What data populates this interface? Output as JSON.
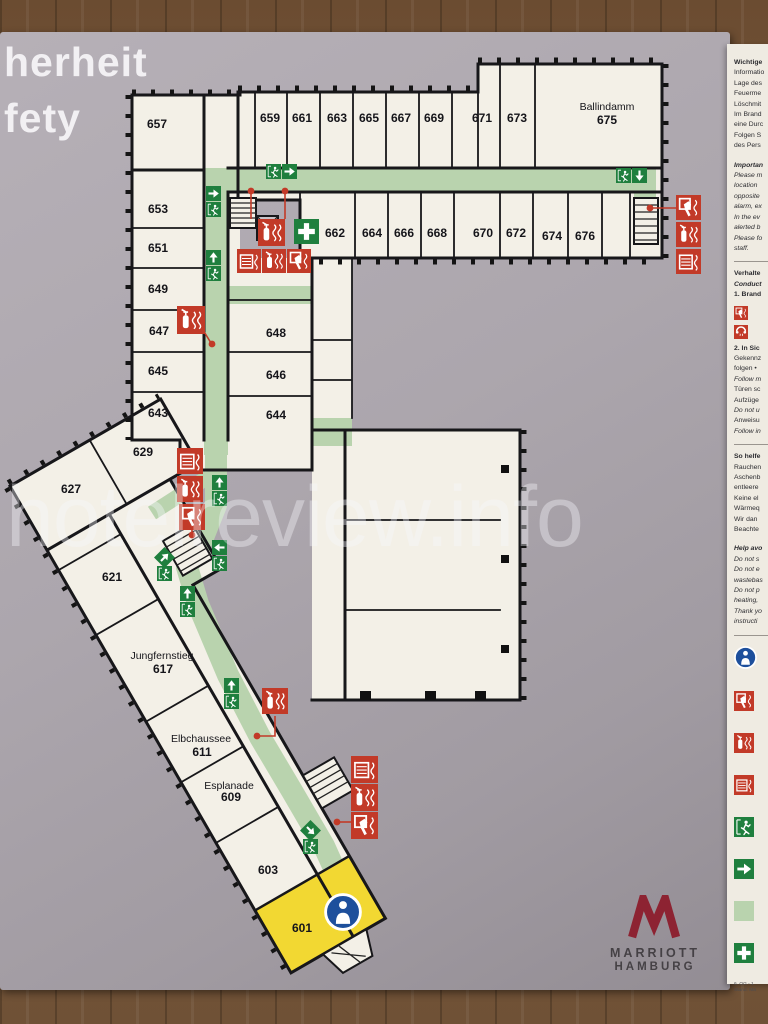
{
  "title": {
    "line1": "herheit",
    "line2": "fety"
  },
  "watermark": "hotelreview.info",
  "logo": {
    "name": "MARRIOTT",
    "city": "HAMBURG"
  },
  "colors": {
    "safety_red": "#c23a28",
    "sign_green": "#1f7f3e",
    "marker_blue": "#1d4f9c",
    "corridor_green": "#b9d3ae",
    "room_yellow": "#f2d832",
    "brand_red": "#8d2332",
    "board_gray": "#aba5ac",
    "room_fill": "#f3f0e7",
    "panel_bg": "#efebe2"
  },
  "plan": {
    "rooms": [
      {
        "label": "657",
        "x": 157,
        "y": 128
      },
      {
        "label": "653",
        "x": 158,
        "y": 213
      },
      {
        "label": "651",
        "x": 158,
        "y": 252
      },
      {
        "label": "649",
        "x": 158,
        "y": 293
      },
      {
        "label": "647",
        "x": 159,
        "y": 335
      },
      {
        "label": "645",
        "x": 158,
        "y": 375
      },
      {
        "label": "643",
        "x": 158,
        "y": 417
      },
      {
        "label": "648",
        "x": 276,
        "y": 337
      },
      {
        "label": "646",
        "x": 276,
        "y": 379
      },
      {
        "label": "644",
        "x": 276,
        "y": 419
      },
      {
        "label": "659",
        "x": 270,
        "y": 122
      },
      {
        "label": "661",
        "x": 302,
        "y": 122
      },
      {
        "label": "663",
        "x": 337,
        "y": 122
      },
      {
        "label": "665",
        "x": 369,
        "y": 122
      },
      {
        "label": "667",
        "x": 401,
        "y": 122
      },
      {
        "label": "669",
        "x": 434,
        "y": 122
      },
      {
        "label": "671",
        "x": 482,
        "y": 122
      },
      {
        "label": "673",
        "x": 517,
        "y": 122
      },
      {
        "label": "675",
        "x": 607,
        "y": 124
      },
      {
        "label": "662",
        "x": 335,
        "y": 237
      },
      {
        "label": "664",
        "x": 372,
        "y": 237
      },
      {
        "label": "666",
        "x": 404,
        "y": 237
      },
      {
        "label": "668",
        "x": 437,
        "y": 237
      },
      {
        "label": "670",
        "x": 483,
        "y": 237
      },
      {
        "label": "672",
        "x": 516,
        "y": 237
      },
      {
        "label": "674",
        "x": 552,
        "y": 240
      },
      {
        "label": "676",
        "x": 585,
        "y": 240
      },
      {
        "label": "629",
        "x": 143,
        "y": 456
      },
      {
        "label": "627",
        "x": 71,
        "y": 493
      },
      {
        "label": "621",
        "x": 112,
        "y": 581
      },
      {
        "label": "617",
        "x": 163,
        "y": 673
      },
      {
        "label": "611",
        "x": 202,
        "y": 756
      },
      {
        "label": "609",
        "x": 231,
        "y": 801
      },
      {
        "label": "603",
        "x": 268,
        "y": 874
      },
      {
        "label": "601",
        "x": 302,
        "y": 932
      }
    ],
    "street_labels": [
      {
        "label": "Ballindamm",
        "x": 607,
        "y": 110
      },
      {
        "label": "Jungfernstieg",
        "x": 162,
        "y": 659
      },
      {
        "label": "Elbchaussee",
        "x": 201,
        "y": 742
      },
      {
        "label": "Esplanade",
        "x": 229,
        "y": 789
      }
    ],
    "exit_signs": [
      {
        "x": 266,
        "y": 164,
        "layout": "h",
        "dir": "right"
      },
      {
        "x": 206,
        "y": 186,
        "layout": "v",
        "dir": "right"
      },
      {
        "x": 206,
        "y": 250,
        "layout": "v",
        "dir": "up"
      },
      {
        "x": 616,
        "y": 168,
        "layout": "h",
        "dir": "down"
      },
      {
        "x": 212,
        "y": 475,
        "layout": "v",
        "dir": "up"
      },
      {
        "x": 212,
        "y": 540,
        "layout": "v",
        "dir": "left"
      },
      {
        "x": 157,
        "y": 550,
        "layout": "v",
        "dir": "ne"
      },
      {
        "x": 180,
        "y": 586,
        "layout": "v",
        "dir": "up"
      },
      {
        "x": 224,
        "y": 678,
        "layout": "v",
        "dir": "up"
      },
      {
        "x": 303,
        "y": 823,
        "layout": "v",
        "dir": "se"
      }
    ],
    "safety_icons": [
      {
        "t": "fire-extinguisher",
        "x": 258,
        "y": 219,
        "s": 27
      },
      {
        "t": "first-aid",
        "x": 294,
        "y": 219,
        "s": 25
      },
      {
        "t": "wall-hydrant",
        "x": 237,
        "y": 249,
        "s": 24
      },
      {
        "t": "fire-extinguisher",
        "x": 262,
        "y": 249,
        "s": 24
      },
      {
        "t": "fire-alarm-button",
        "x": 287,
        "y": 249,
        "s": 24
      },
      {
        "t": "fire-extinguisher",
        "x": 177,
        "y": 306,
        "s": 28
      },
      {
        "t": "fire-alarm-button",
        "x": 676,
        "y": 195,
        "s": 25
      },
      {
        "t": "fire-extinguisher",
        "x": 676,
        "y": 222,
        "s": 25
      },
      {
        "t": "wall-hydrant",
        "x": 676,
        "y": 249,
        "s": 25
      },
      {
        "t": "wall-hydrant",
        "x": 177,
        "y": 448,
        "s": 26
      },
      {
        "t": "fire-extinguisher",
        "x": 177,
        "y": 476,
        "s": 26
      },
      {
        "t": "fire-alarm-button",
        "x": 179,
        "y": 504,
        "s": 26
      },
      {
        "t": "fire-extinguisher",
        "x": 262,
        "y": 688,
        "s": 26
      },
      {
        "t": "wall-hydrant",
        "x": 351,
        "y": 756,
        "s": 27
      },
      {
        "t": "fire-extinguisher",
        "x": 351,
        "y": 784,
        "s": 27
      },
      {
        "t": "fire-alarm-button",
        "x": 351,
        "y": 812,
        "s": 27
      },
      {
        "t": "you-are-here",
        "x": 324,
        "y": 893,
        "s": 38
      }
    ],
    "red_links": [
      {
        "d": "M251,192 V219",
        "dot": [
          251,
          191
        ]
      },
      {
        "d": "M285,192 V219",
        "dot": [
          285,
          191
        ]
      },
      {
        "d": "M650,208 H676",
        "dot": [
          650,
          208
        ]
      },
      {
        "d": "M203,330 L211,343",
        "dot": [
          212,
          344
        ]
      },
      {
        "d": "M192,510 V533",
        "dot": [
          192,
          535
        ]
      },
      {
        "d": "M275,716 V736 H260",
        "dot": [
          257,
          736
        ]
      },
      {
        "d": "M339,822 H351",
        "dot": [
          337,
          822
        ]
      }
    ]
  },
  "sidebar": {
    "blocks": [
      {
        "type": "lines",
        "lines": [
          {
            "t": "Wichtige",
            "s": "b"
          },
          {
            "t": "Informatio",
            "s": "n"
          },
          {
            "t": "Lage des",
            "s": "n"
          },
          {
            "t": "Feuerme",
            "s": "n"
          },
          {
            "t": "Löschmit",
            "s": "n"
          },
          {
            "t": "Im Brand",
            "s": "n"
          },
          {
            "t": "eine Durc",
            "s": "n"
          },
          {
            "t": "Folgen S",
            "s": "n"
          },
          {
            "t": "des Pers",
            "s": "n"
          },
          {
            "t": "",
            "s": "gap"
          },
          {
            "t": "Importan",
            "s": "bi"
          },
          {
            "t": "Please m",
            "s": "i"
          },
          {
            "t": "location",
            "s": "i"
          },
          {
            "t": "opposite",
            "s": "i"
          },
          {
            "t": "alarm, ex",
            "s": "i"
          },
          {
            "t": "In the ev",
            "s": "i"
          },
          {
            "t": "alerted b",
            "s": "i"
          },
          {
            "t": "Please fo",
            "s": "i"
          },
          {
            "t": "staff.",
            "s": "i"
          }
        ]
      },
      {
        "type": "rule"
      },
      {
        "type": "lines",
        "lines": [
          {
            "t": "Verhalte",
            "s": "b"
          },
          {
            "t": "Conduct",
            "s": "bi"
          },
          {
            "t": "1. Brand",
            "s": "b"
          }
        ]
      },
      {
        "type": "icons",
        "icons": [
          "fire-alarm-button",
          "telephone"
        ]
      },
      {
        "type": "lines",
        "lines": [
          {
            "t": "2. In Sic",
            "s": "b"
          },
          {
            "t": "Gekennz",
            "s": "n"
          },
          {
            "t": "folgen •",
            "s": "n"
          },
          {
            "t": "Follow m",
            "s": "i"
          },
          {
            "t": "Türen sc",
            "s": "n"
          },
          {
            "t": "Aufzüge",
            "s": "n"
          },
          {
            "t": "Do not u",
            "s": "i"
          },
          {
            "t": "Anweisu",
            "s": "n"
          },
          {
            "t": "Follow in",
            "s": "i"
          }
        ]
      },
      {
        "type": "rule"
      },
      {
        "type": "lines",
        "lines": [
          {
            "t": "So helfe",
            "s": "b"
          },
          {
            "t": "Rauchen",
            "s": "n"
          },
          {
            "t": "Aschenb",
            "s": "n"
          },
          {
            "t": "entleere",
            "s": "n"
          },
          {
            "t": "Keine el",
            "s": "n"
          },
          {
            "t": "Wärmeq",
            "s": "n"
          },
          {
            "t": "Wir dan",
            "s": "n"
          },
          {
            "t": "Beachte",
            "s": "n"
          },
          {
            "t": "",
            "s": "gap"
          },
          {
            "t": "Help avo",
            "s": "bi"
          },
          {
            "t": "Do not s",
            "s": "i"
          },
          {
            "t": "Do not e",
            "s": "i"
          },
          {
            "t": "wastebas",
            "s": "i"
          },
          {
            "t": "Do not p",
            "s": "i"
          },
          {
            "t": "heating,",
            "s": "i"
          },
          {
            "t": "Thank yo",
            "s": "i"
          },
          {
            "t": "instructi",
            "s": "i"
          }
        ]
      },
      {
        "type": "rule"
      },
      {
        "type": "legend",
        "items": [
          {
            "icon": "you-are-here"
          },
          {
            "icon": "fire-alarm-button"
          },
          {
            "icon": "fire-extinguisher"
          },
          {
            "icon": "wall-hydrant"
          },
          {
            "icon": "emergency-exit"
          },
          {
            "icon": "escape-arrow"
          },
          {
            "icon": "escape-route"
          },
          {
            "icon": "first-aid"
          }
        ]
      },
      {
        "type": "footnote",
        "lines": [
          "6. OG - 1",
          "Stand: Mä"
        ]
      }
    ]
  }
}
